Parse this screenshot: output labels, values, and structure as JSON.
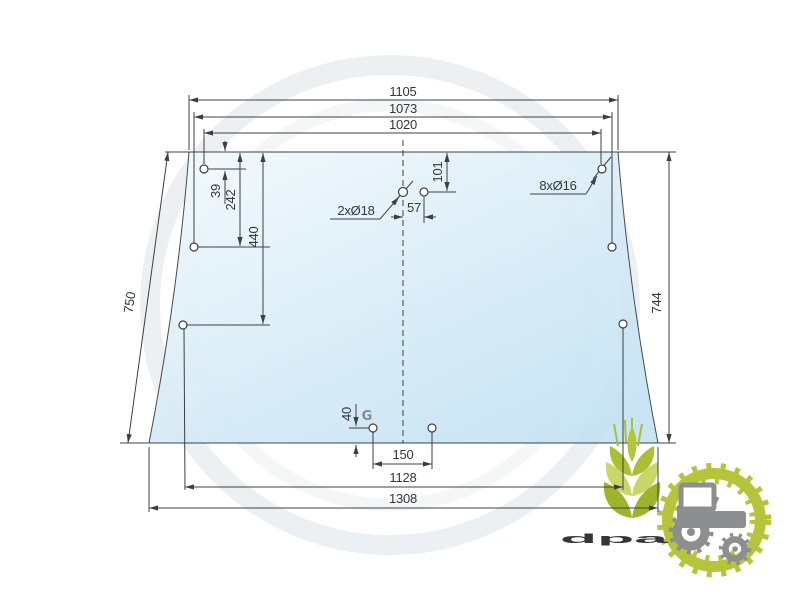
{
  "drawing": {
    "watermark_letter": "G",
    "dimensions": {
      "top_outer": "1105",
      "top_middle": "1073",
      "top_inner": "1020",
      "left_slant": "750",
      "right_height": "744",
      "left_hole_first": "39",
      "left_hole_second": "242",
      "left_hole_third": "440",
      "center_hole_drop": "101",
      "center_hole_offset": "57",
      "bottom_hole_rise": "40",
      "bottom_hole_span": "150",
      "bottom_inner": "1128",
      "bottom_outer": "1308"
    },
    "callouts": {
      "center_holes": "2xØ18",
      "edge_holes": "8xØ16"
    },
    "colors": {
      "glass_light": "#f3fafd",
      "glass_dark": "#c4e2f2",
      "line": "#3c4043",
      "watermark": "#edf0f3"
    }
  },
  "logo": {
    "text": "dpa",
    "colors": {
      "green": "#b5c43b",
      "green_light": "#c9d768",
      "green_dark": "#9fb42c",
      "gray": "#8b8d8f"
    }
  }
}
